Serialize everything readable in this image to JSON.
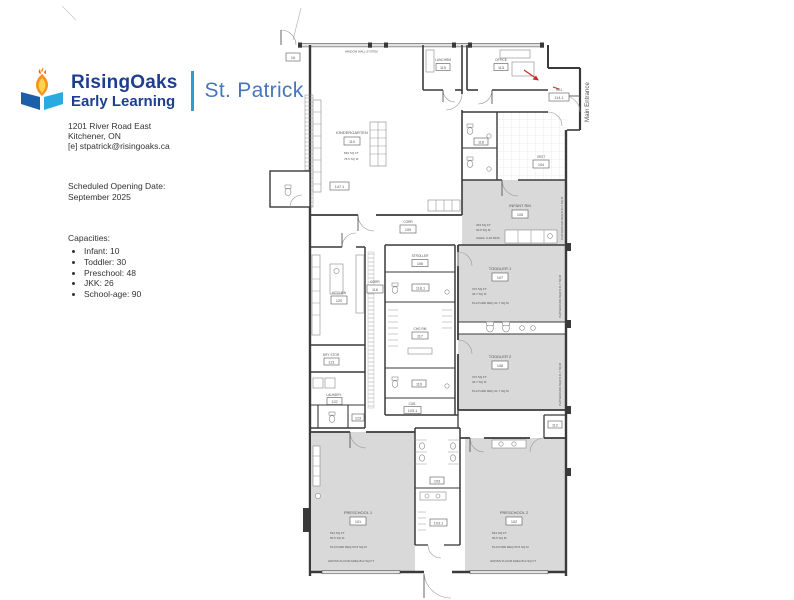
{
  "brand": {
    "name": "RisingOaks",
    "subname": "Early Learning",
    "site": "St. Patrick"
  },
  "contact": {
    "line1": "1201 River Road East",
    "line2": "Kitchener, ON",
    "line3": "[e] stpatrick@risingoaks.ca"
  },
  "opening": {
    "label": "Scheduled Opening Date:",
    "value": "September 2025"
  },
  "capacities": {
    "title": "Capacities:",
    "items": [
      "Infant: 10",
      "Toddler: 30",
      "Preschool: 48",
      "JKK: 26",
      "School-age: 90"
    ]
  },
  "colors": {
    "brand_navy": "#1e3f8f",
    "brand_blue": "#4677bd",
    "divider_blue": "#2e9bd6",
    "logo_yellow": "#ffd34f",
    "logo_orange": "#f7941d",
    "logo_cyan": "#29abe2",
    "logo_navy": "#1b5faa",
    "accent_red": "#cc2a2a",
    "room_gray": "#d9d9d9"
  },
  "plan": {
    "notes": {
      "main_entrance": "Main Entrance",
      "window_note": "WINDOW WALL SYSTEM",
      "playground_note": "PLAYGROUND REQ'D 41.7 SQ M",
      "door_tag": "16",
      "wr_tag": "147.1"
    },
    "rooms": {
      "kindergarten": {
        "name": "KINDERGARTEN",
        "num": "110",
        "lines": [
          "846 SQ FT",
          "78.6 SQ M"
        ]
      },
      "lunchrm": {
        "name": "LUNCHRM",
        "num": "115"
      },
      "office": {
        "name": "OFFICE",
        "num": "113"
      },
      "hb1": {
        "name": "HB1",
        "num": "114.1"
      },
      "vest": {
        "name": "VEST",
        "num": "104"
      },
      "wr_top": {
        "name": "WR",
        "num": "118"
      },
      "corr_a": {
        "name": "CORR",
        "num": "109"
      },
      "corr_b": {
        "name": "CORR",
        "num": "116"
      },
      "infant": {
        "name": "INFANT RM",
        "num": "105",
        "lines": [
          "333 SQ FT",
          "30.9 SQ M",
          "AGES: 0-18 MOS"
        ]
      },
      "toddler1": {
        "name": "TODDLER 1",
        "num": "107",
        "lines": [
          "373 SQ FT",
          "34.7 SQ M",
          "PLAYGRD REQ 41.7 SQ M"
        ]
      },
      "toddler2": {
        "name": "TODDLER 2",
        "num": "108",
        "lines": [
          "373 SQ FT",
          "34.7 SQ M",
          "PLAYGRD REQ 41.7 SQ M"
        ]
      },
      "kitchen": {
        "name": "KITCHEN",
        "num": "120"
      },
      "drystor": {
        "name": "DRY STOR",
        "num": "121"
      },
      "laundry": {
        "name": "LAUNDRY",
        "num": "122"
      },
      "wr_laundry": {
        "name": "WR",
        "num": "123"
      },
      "stroller": {
        "name": "STROLLER",
        "num": "106"
      },
      "wr_a": {
        "name": "WR",
        "num": "118.1"
      },
      "chg": {
        "name": "CHG RM",
        "num": "117"
      },
      "wr_b": {
        "name": "WR",
        "num": "119"
      },
      "cub": {
        "name": "CUB",
        "num": "103.1"
      },
      "wrcorr": {
        "name": "WR",
        "num": "103"
      },
      "jan": {
        "name": "JAN",
        "num": "112"
      },
      "preschool1": {
        "name": "PRESCHOOL 1",
        "num": "101",
        "lines": [
          "544 SQ FT",
          "50.5 SQ M",
          "PLAYGRD REQ 50.5 SQ M"
        ],
        "gross": "GROSS FLOOR AREA   814 SQ FT"
      },
      "preschool2": {
        "name": "PRESCHOOL 2",
        "num": "102",
        "lines": [
          "544 SQ FT",
          "50.5 SQ M",
          "PLAYGRD REQ 50.5 SQ M"
        ],
        "gross": "GROSS FLOOR AREA   814 SQ FT"
      }
    }
  }
}
